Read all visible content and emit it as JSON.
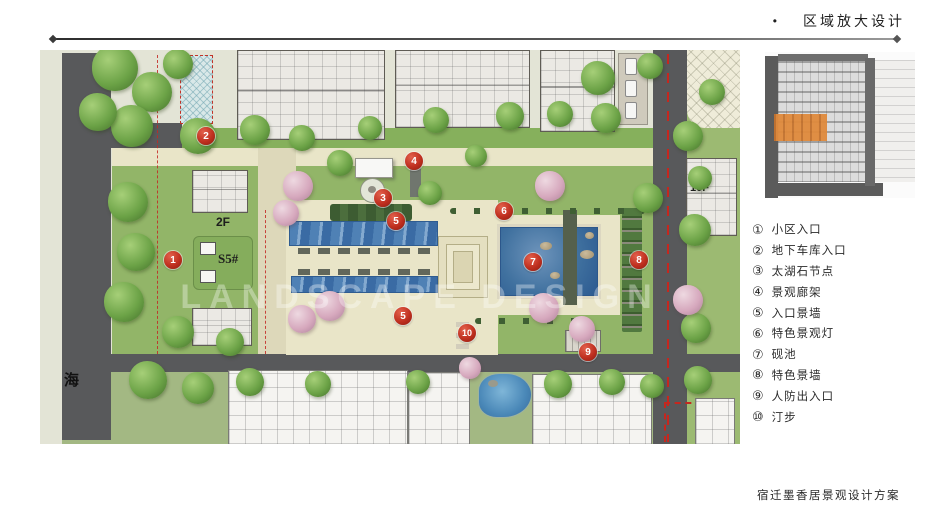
{
  "header": {
    "bullet": "•",
    "title": "区域放大设计"
  },
  "footer": {
    "title": "宿迁墨香居景观设计方案"
  },
  "watermark": "LANDSCAPE DESIGN",
  "colors": {
    "marker_red": "#c03020",
    "locator_highlight_orange": "#e08a3c",
    "water_blue": "#3f74ad",
    "road_gray": "#58595b"
  },
  "plan": {
    "labels": {
      "building_2f": "2F",
      "building_s5": "S5#",
      "building_10f": "10F",
      "road_name": "海"
    },
    "markers": [
      {
        "num": "1"
      },
      {
        "num": "2"
      },
      {
        "num": "3"
      },
      {
        "num": "4"
      },
      {
        "num": "5"
      },
      {
        "num": "5"
      },
      {
        "num": "6"
      },
      {
        "num": "7"
      },
      {
        "num": "8"
      },
      {
        "num": "9"
      },
      {
        "num": "10"
      }
    ]
  },
  "legend": {
    "items": [
      {
        "symbol": "①",
        "label": "小区入口"
      },
      {
        "symbol": "②",
        "label": "地下车库入口"
      },
      {
        "symbol": "③",
        "label": "太湖石节点"
      },
      {
        "symbol": "④",
        "label": "景观廊架"
      },
      {
        "symbol": "⑤",
        "label": "入口景墙"
      },
      {
        "symbol": "⑥",
        "label": "特色景观灯"
      },
      {
        "symbol": "⑦",
        "label": "砚池"
      },
      {
        "symbol": "⑧",
        "label": "特色景墙"
      },
      {
        "symbol": "⑨",
        "label": "人防出入口"
      },
      {
        "symbol": "⑩",
        "label": "汀步"
      }
    ]
  }
}
